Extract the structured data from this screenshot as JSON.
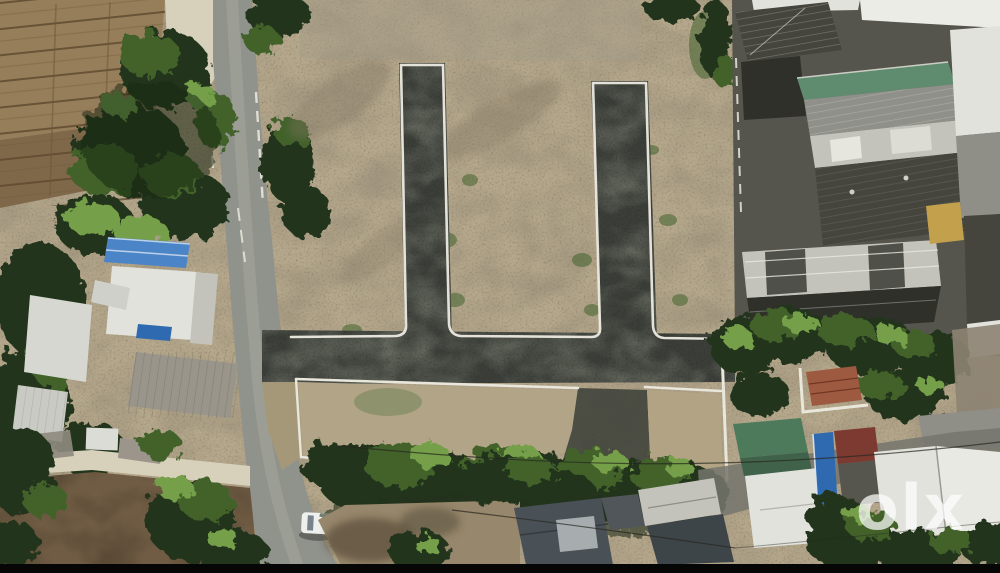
{
  "image": {
    "kind": "aerial-drone-photograph",
    "description": "Top-down aerial view of a vacant real-estate plot with two newly laid black tar internal roads joining a horizontal tar road, white painted curbs and compound walls, a public village road with trees and houses on the left, farm furrow plots top-left, a dense row of building rooftops on the right, tree bands and rooftops at the bottom, and an olx watermark at bottom right",
    "width_px": 1000,
    "height_px": 573
  },
  "watermark": {
    "text": "olx",
    "color": "#ffffff",
    "opacity": 0.72
  },
  "scene": {
    "regions": [
      "farm-furrow-plots",
      "public-road",
      "roadside-trees",
      "blue-roof-house",
      "white-concrete-roofs",
      "weathered-metal-roof",
      "vacant-plot-dirt",
      "internal-tar-road-left",
      "internal-tar-road-right",
      "internal-tar-road-horizontal",
      "white-curbs",
      "white-compound-walls",
      "lower-land-parcels",
      "tree-canopy-band",
      "rowhouse-rooftops",
      "green-metal-roof",
      "red-tile-roof-house",
      "yellow-shed",
      "bottom-white-rooftops",
      "blue-water-tank",
      "maroon-roof",
      "parked-white-car",
      "motorcycle",
      "power-lines",
      "letterbox-bar",
      "olx-watermark"
    ]
  },
  "palette": {
    "dirt": "#b5a88c",
    "dirt_dark": "#705c44",
    "asphalt_new": "#3c3f39",
    "road_gray": "#90928c",
    "path_light": "#d7d1bb",
    "curb_white": "#edebe1",
    "wall_white": "#e9e7db",
    "farm_brown": "#967e5a",
    "farm_dark": "#7f684a",
    "foliage_dark": "#24351c",
    "foliage_mid": "#42622c",
    "foliage_bright": "#74a04a",
    "roof_blue": "#4c84c8",
    "roof_white": "#e2e2dc",
    "roof_light": "#c3c3bb",
    "roof_gray": "#8f8f87",
    "roof_dark": "#45453e",
    "roof_darker": "#30302b",
    "roof_green": "#5f8c6e",
    "roof_teal": "#4e7a5c",
    "roof_red": "#9e5a40",
    "roof_maroon": "#7c3a30",
    "water_blue": "#2f69b0",
    "yellow_struct": "#c2a04c",
    "letterbox": "#060606"
  }
}
